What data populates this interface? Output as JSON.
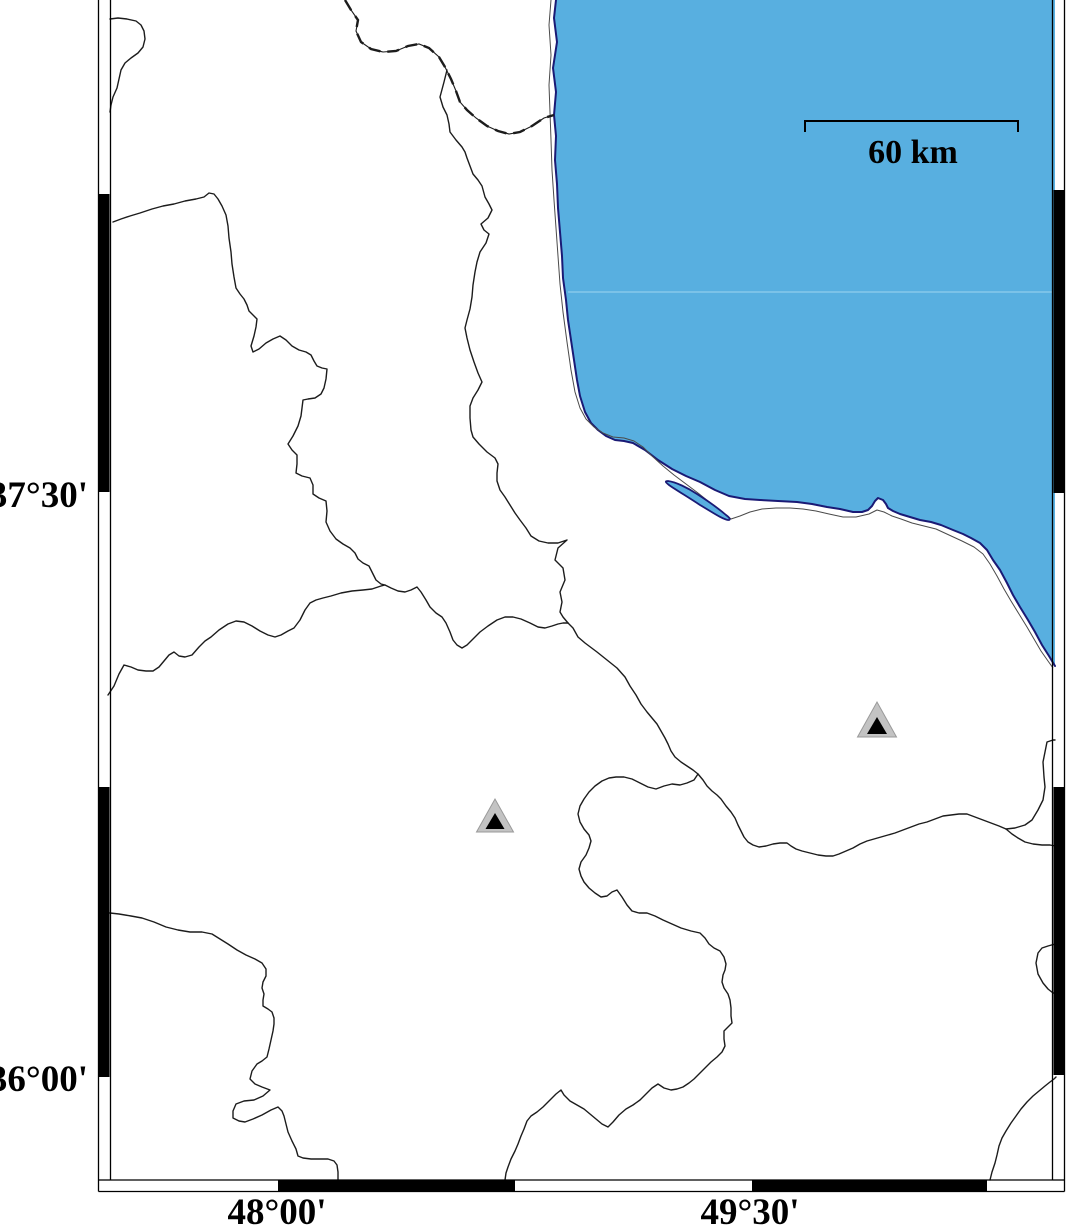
{
  "figure": {
    "type": "map",
    "description": "Coastal map with fancy checker frame, sea in upper right, administrative boundaries, dashed international border and two triangle station markers",
    "axis": {
      "lat_labels": [
        {
          "text": "37°30'",
          "y": 494
        },
        {
          "text": "36°00'",
          "y": 1078
        }
      ],
      "lon_labels": [
        {
          "text": "48°00'",
          "x": 277
        },
        {
          "text": "49°30'",
          "x": 750
        }
      ]
    },
    "scale_bar": {
      "label": "60 km",
      "x1": 805,
      "x2": 1018,
      "y": 121,
      "tick_len": 11,
      "label_x": 913,
      "label_y": 163
    },
    "markers": [
      {
        "cx": 877,
        "base_y": 737,
        "w": 39,
        "h": 35,
        "inner_w": 20,
        "inner_h": 17
      },
      {
        "cx": 495,
        "base_y": 832,
        "w": 37,
        "h": 33,
        "inner_w": 19,
        "inner_h": 16
      }
    ],
    "colors": {
      "sea": "#58AFE0",
      "sea_divider": "#9AD2EF",
      "coast": "#1A1A75",
      "boundary": "#1C1C1C",
      "frame": "#000000",
      "marker_outer": "#C3C3C3",
      "marker_edge": "#9A9A9A",
      "marker_inner": "#000000"
    },
    "frame": {
      "inner": {
        "left": 110,
        "right": 1053,
        "bottom": 1180
      },
      "outer": {
        "left": 98.5,
        "right": 1064.5,
        "bottom": 1191.5
      },
      "left_black": [
        [
          194,
          492
        ],
        [
          787,
          1077
        ]
      ],
      "right_black": [
        [
          190,
          493
        ],
        [
          787,
          1075
        ]
      ],
      "bottom_black": [
        [
          278,
          515
        ],
        [
          752,
          987
        ]
      ]
    }
  }
}
